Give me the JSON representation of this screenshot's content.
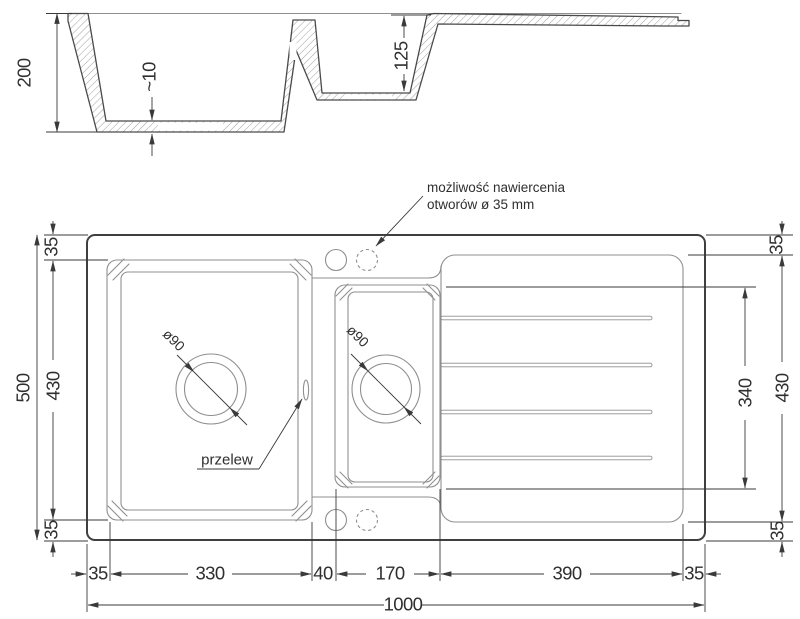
{
  "meta": {
    "drawing_type": "kitchen sink technical drawing, section and plan views",
    "colors": {
      "bg": "#ffffff",
      "line": "#3f3f3f",
      "thin": "#8f8f8f",
      "dim": "#3a3a3a",
      "txt": "#2f2f2f",
      "hatch": "#a0a0a0"
    }
  },
  "labels": {
    "note1": "możliwość nawiercenia",
    "note2": "otworów ø 35 mm",
    "przelew": "przelew",
    "drain_main": "ø90",
    "drain_small": "ø90"
  },
  "section": {
    "height": "200",
    "thickness": "~10",
    "depth": "125"
  },
  "top": {
    "left": {
      "overall": "500",
      "bowl": "430",
      "top": "35",
      "bottom": "35"
    },
    "right": {
      "board": "430",
      "inner": "340",
      "top": "35",
      "bottom": "35"
    },
    "bottom": {
      "m1": "35",
      "main": "330",
      "gap": "40",
      "small": "170",
      "board": "390",
      "m2": "35",
      "overall": "1000"
    }
  }
}
